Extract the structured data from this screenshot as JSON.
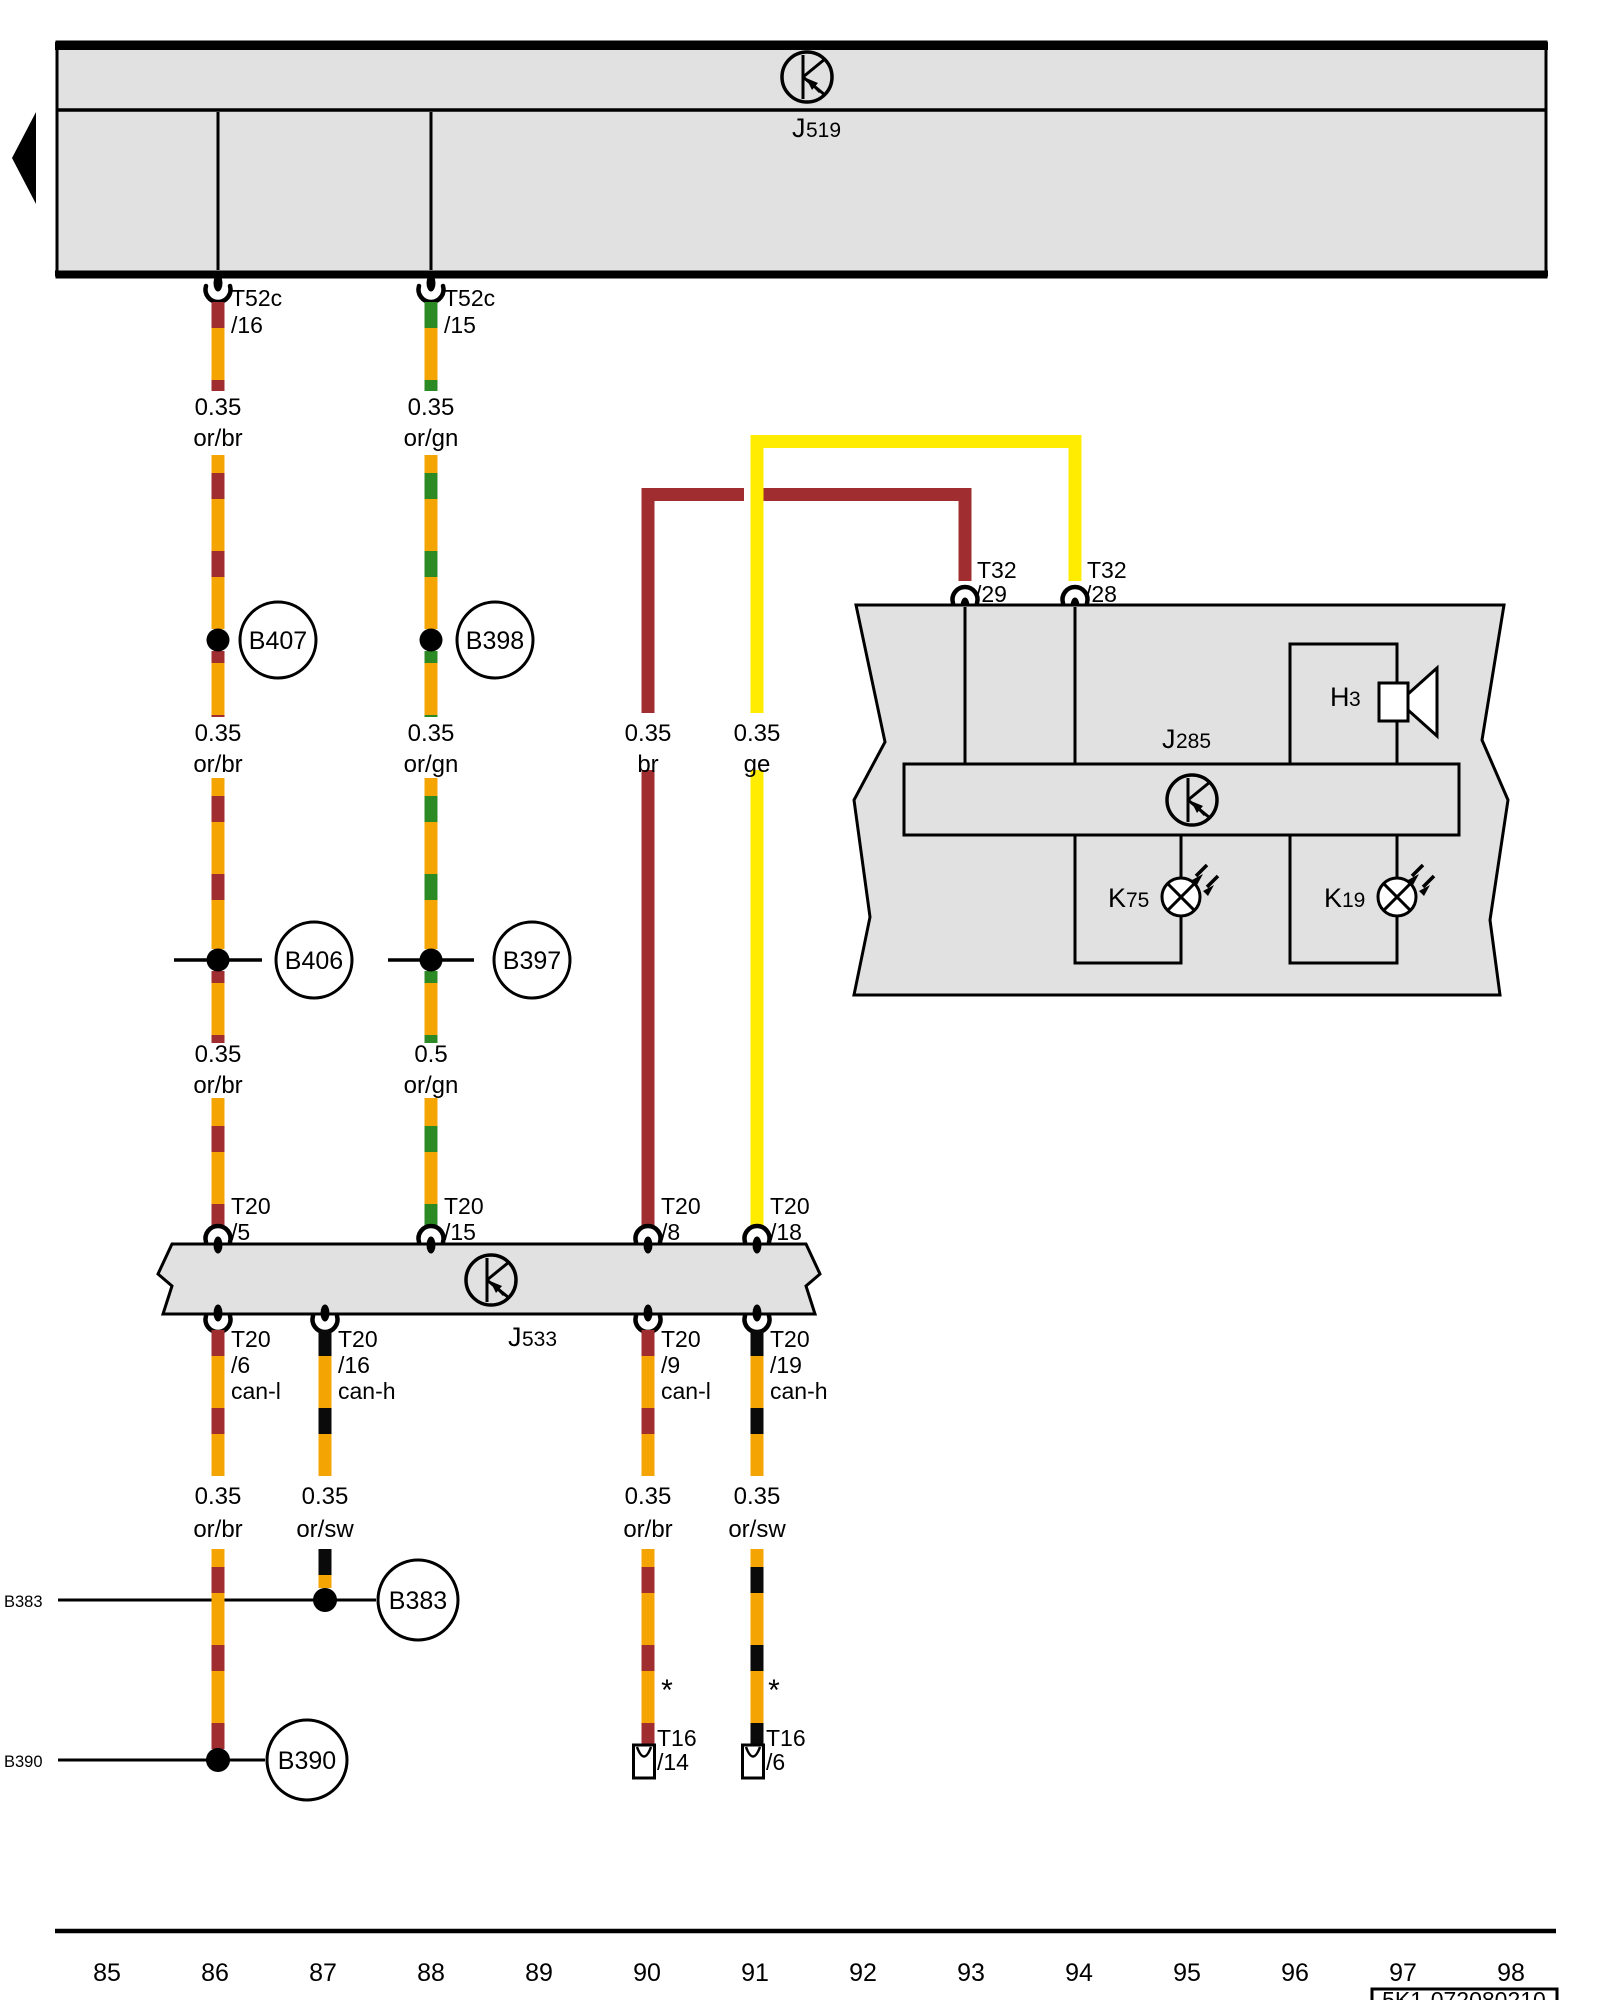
{
  "colors": {
    "wire_orange": "#F4A503",
    "wire_brown_red": "#A02E31",
    "wire_green": "#2C8A24",
    "wire_yellow": "#FFEC00",
    "wire_black": "#0A0A0A",
    "box_gray": "#E1E1E1"
  },
  "control_units": {
    "j519": {
      "letter": "J",
      "number": "519"
    },
    "j533": {
      "letter": "J",
      "number": "533"
    },
    "j285": {
      "letter": "J",
      "number": "285"
    }
  },
  "devices": {
    "h3": {
      "letter": "H",
      "number": "3"
    },
    "k75": {
      "letter": "K",
      "number": "75"
    },
    "k19": {
      "letter": "K",
      "number": "19"
    }
  },
  "connectors": {
    "t52c_16": {
      "name": "T52c",
      "pin": "/16"
    },
    "t52c_15": {
      "name": "T52c",
      "pin": "/15"
    },
    "t32_29": {
      "name": "T32",
      "pin": "/29"
    },
    "t32_28": {
      "name": "T32",
      "pin": "/28"
    },
    "t20_5": {
      "name": "T20",
      "pin": "/5"
    },
    "t20_15": {
      "name": "T20",
      "pin": "/15"
    },
    "t20_8": {
      "name": "T20",
      "pin": "/8"
    },
    "t20_18": {
      "name": "T20",
      "pin": "/18"
    },
    "t20_6": {
      "name": "T20",
      "pin": "/6",
      "bus": "can-l"
    },
    "t20_16": {
      "name": "T20",
      "pin": "/16",
      "bus": "can-h"
    },
    "t20_9": {
      "name": "T20",
      "pin": "/9",
      "bus": "can-l"
    },
    "t20_19": {
      "name": "T20",
      "pin": "/19",
      "bus": "can-h"
    },
    "t16_14": {
      "name": "T16",
      "pin": "/14"
    },
    "t16_6": {
      "name": "T16",
      "pin": "/6"
    }
  },
  "wire_labels": {
    "w1_r1": {
      "gauge": "0.35",
      "color": "or/br"
    },
    "w1_r2": {
      "gauge": "0.35",
      "color": "or/br"
    },
    "w1_r3": {
      "gauge": "0.35",
      "color": "or/br"
    },
    "w1_r4": {
      "gauge": "0.35",
      "color": "or/br"
    },
    "w2_r1": {
      "gauge": "0.35",
      "color": "or/gn"
    },
    "w2_r2": {
      "gauge": "0.35",
      "color": "or/gn"
    },
    "w2_r3": {
      "gauge": "0.5",
      "color": "or/gn"
    },
    "w2_r4": {
      "gauge": "0.35",
      "color": "or/sw"
    },
    "w3_r2": {
      "gauge": "0.35",
      "color": "br"
    },
    "w3_r4": {
      "gauge": "0.35",
      "color": "or/br"
    },
    "w4_r2": {
      "gauge": "0.35",
      "color": "ge"
    },
    "w4_r4": {
      "gauge": "0.35",
      "color": "or/sw"
    }
  },
  "junctions": {
    "b407": "B407",
    "b398": "B398",
    "b406": "B406",
    "b397": "B397",
    "b383": "B383",
    "b390": "B390"
  },
  "edge_labels": {
    "b383": "B383",
    "b390": "B390"
  },
  "asterisk": "*",
  "grid_numbers": [
    "85",
    "86",
    "87",
    "88",
    "89",
    "90",
    "91",
    "92",
    "93",
    "94",
    "95",
    "96",
    "97",
    "98"
  ],
  "part_number": "5K1-072080210"
}
